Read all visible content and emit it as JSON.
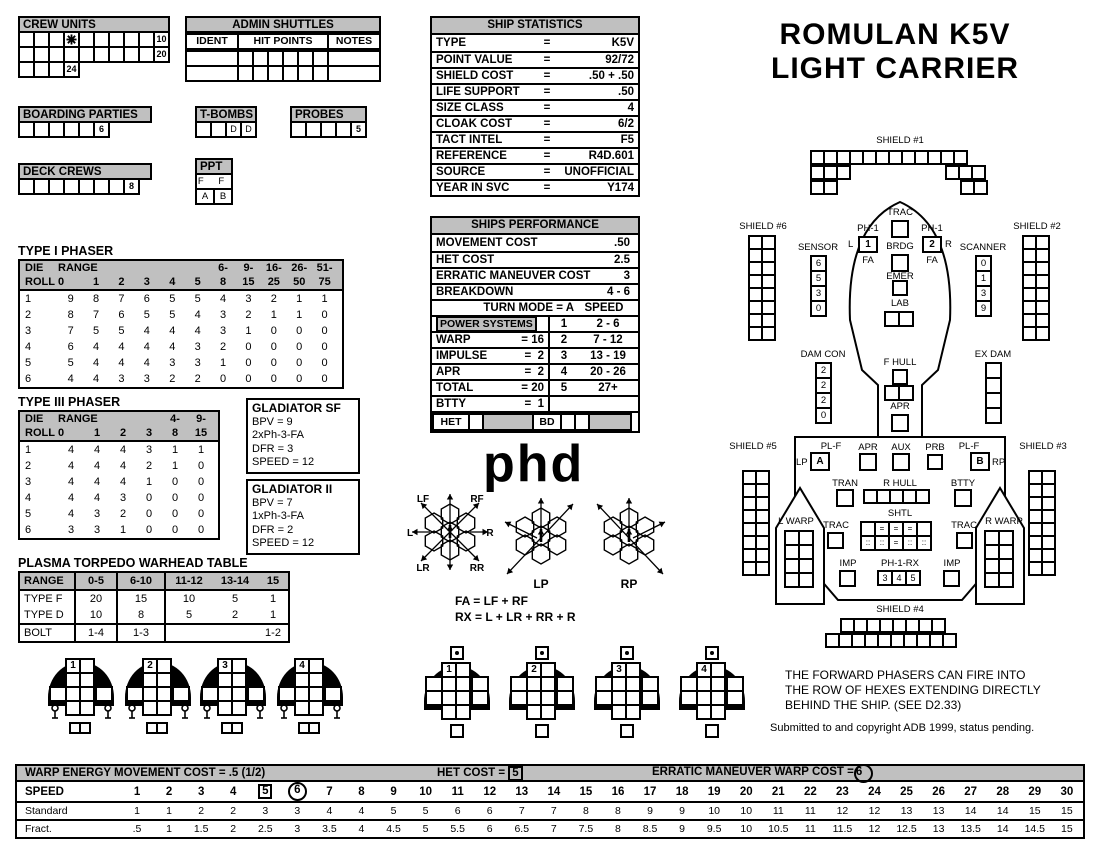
{
  "title": {
    "line1": "ROMULAN K5V",
    "line2": "LIGHT CARRIER"
  },
  "colors": {
    "header_gray": "#c0c0c0",
    "ink": "#000000"
  },
  "crew_units": {
    "title": "CREW UNITS",
    "rows": [
      {
        "cells": [
          "",
          "",
          "",
          "*",
          "",
          "",
          "",
          "",
          "",
          "10"
        ]
      },
      {
        "cells": [
          "",
          "",
          "",
          "",
          "",
          "",
          "",
          "",
          "",
          "20"
        ]
      },
      {
        "cells": [
          "",
          "",
          "",
          "24"
        ]
      }
    ]
  },
  "admin_shuttles": {
    "title": "ADMIN SHUTTLES",
    "columns": [
      "IDENT",
      "HIT POINTS",
      "NOTES"
    ],
    "hit_cells": 6,
    "rows": 2
  },
  "boarding_parties": {
    "title": "BOARDING PARTIES",
    "cells": [
      "",
      "",
      "",
      "",
      "",
      "6"
    ]
  },
  "t_bombs": {
    "title": "T-BOMBS",
    "cells": [
      "",
      "",
      "D",
      "D"
    ]
  },
  "probes": {
    "title": "PROBES",
    "cells": [
      "",
      "",
      "",
      "",
      "5"
    ]
  },
  "deck_crews": {
    "title": "DECK CREWS",
    "cells": [
      "",
      "",
      "",
      "",
      "",
      "",
      "",
      "8"
    ]
  },
  "ppt": {
    "title": "PPT",
    "row1": "F F",
    "row2": [
      "A",
      "B"
    ]
  },
  "ship_statistics": {
    "title": "SHIP STATISTICS",
    "rows": [
      {
        "label": "TYPE",
        "eq": "=",
        "value": "K5V"
      },
      {
        "label": "POINT VALUE",
        "eq": "=",
        "value": "92/72"
      },
      {
        "label": "SHIELD COST",
        "eq": "=",
        "value": ".50 + .50"
      },
      {
        "label": "LIFE SUPPORT",
        "eq": "=",
        "value": ".50"
      },
      {
        "label": "SIZE CLASS",
        "eq": "=",
        "value": "4"
      },
      {
        "label": "CLOAK COST",
        "eq": "=",
        "value": "6/2"
      },
      {
        "label": "TACT INTEL",
        "eq": "=",
        "value": "F5"
      },
      {
        "label": "REFERENCE",
        "eq": "=",
        "value": "R4D.601"
      },
      {
        "label": "SOURCE",
        "eq": "=",
        "value": "UNOFFICIAL"
      },
      {
        "label": "YEAR IN SVC",
        "eq": "=",
        "value": "Y174"
      }
    ]
  },
  "ships_performance": {
    "title": "SHIPS PERFORMANCE",
    "stat_rows": [
      {
        "label": "MOVEMENT COST",
        "value": ".50"
      },
      {
        "label": "HET COST",
        "value": "2.5"
      },
      {
        "label": "ERRATIC MANEUVER COST",
        "value": "3"
      },
      {
        "label": "BREAKDOWN",
        "value": "4 - 6"
      }
    ],
    "turn_mode": "TURN MODE = A",
    "speed_head": "SPEED",
    "power_label": "POWER SYSTEMS",
    "power_rows": [
      {
        "label": "WARP",
        "value": "= 16"
      },
      {
        "label": "IMPULSE",
        "value": "=  2"
      },
      {
        "label": "APR",
        "value": "=  2"
      },
      {
        "label": "TOTAL",
        "value": "= 20"
      },
      {
        "label": "BTTY",
        "value": "=  1"
      }
    ],
    "turn_rows": [
      [
        "1",
        "2 - 6"
      ],
      [
        "2",
        "7 - 12"
      ],
      [
        "3",
        "13 - 19"
      ],
      [
        "4",
        "20 - 26"
      ],
      [
        "5",
        "27+"
      ],
      [
        "",
        ""
      ]
    ],
    "het_label": "HET",
    "bd_label": "BD"
  },
  "type1_phaser": {
    "title": "TYPE I PHASER",
    "col_top": [
      "DIE",
      "RANGE",
      "",
      "",
      "",
      "",
      "",
      "6-",
      "9-",
      "16-",
      "26-",
      "51-"
    ],
    "col_bot": [
      "ROLL",
      "0",
      "1",
      "2",
      "3",
      "4",
      "5",
      "8",
      "15",
      "25",
      "50",
      "75"
    ],
    "rows": [
      {
        "die": "1",
        "vals": [
          "9",
          "8",
          "7",
          "6",
          "5",
          "5",
          "4",
          "3",
          "2",
          "1",
          "1"
        ]
      },
      {
        "die": "2",
        "vals": [
          "8",
          "7",
          "6",
          "5",
          "5",
          "4",
          "3",
          "2",
          "1",
          "1",
          "0"
        ]
      },
      {
        "die": "3",
        "vals": [
          "7",
          "5",
          "5",
          "4",
          "4",
          "4",
          "3",
          "1",
          "0",
          "0",
          "0"
        ]
      },
      {
        "die": "4",
        "vals": [
          "6",
          "4",
          "4",
          "4",
          "4",
          "3",
          "2",
          "0",
          "0",
          "0",
          "0"
        ]
      },
      {
        "die": "5",
        "vals": [
          "5",
          "4",
          "4",
          "4",
          "3",
          "3",
          "1",
          "0",
          "0",
          "0",
          "0"
        ]
      },
      {
        "die": "6",
        "vals": [
          "4",
          "4",
          "3",
          "3",
          "2",
          "2",
          "0",
          "0",
          "0",
          "0",
          "0"
        ]
      }
    ]
  },
  "type3_phaser": {
    "title": "TYPE III PHASER",
    "col_top": [
      "DIE",
      "RANGE",
      "",
      "",
      "",
      "4-",
      "9-"
    ],
    "col_bot": [
      "ROLL",
      "0",
      "1",
      "2",
      "3",
      "8",
      "15"
    ],
    "rows": [
      {
        "die": "1",
        "vals": [
          "4",
          "4",
          "4",
          "3",
          "1",
          "1"
        ]
      },
      {
        "die": "2",
        "vals": [
          "4",
          "4",
          "4",
          "2",
          "1",
          "0"
        ]
      },
      {
        "die": "3",
        "vals": [
          "4",
          "4",
          "4",
          "1",
          "0",
          "0"
        ]
      },
      {
        "die": "4",
        "vals": [
          "4",
          "4",
          "3",
          "0",
          "0",
          "0"
        ]
      },
      {
        "die": "5",
        "vals": [
          "4",
          "3",
          "2",
          "0",
          "0",
          "0"
        ]
      },
      {
        "die": "6",
        "vals": [
          "3",
          "3",
          "1",
          "0",
          "0",
          "0"
        ]
      }
    ]
  },
  "gladiator_sf": {
    "lines": [
      "GLADIATOR SF",
      "BPV = 9",
      "2xPh-3-FA",
      "DFR = 3",
      "SPEED = 12"
    ]
  },
  "gladiator_ii": {
    "lines": [
      "GLADIATOR II",
      "BPV = 7",
      "1xPh-3-FA",
      "DFR = 2",
      "SPEED = 12"
    ]
  },
  "plasma_table": {
    "title": "PLASMA TORPEDO WARHEAD TABLE",
    "header": [
      "RANGE",
      "0-5",
      "6-10",
      "11-12",
      "13-14",
      "15"
    ],
    "rows": [
      {
        "label": "TYPE F",
        "vals": [
          "20",
          "15",
          "10",
          "5",
          "1"
        ]
      },
      {
        "label": "TYPE D",
        "vals": [
          "10",
          "8",
          "5",
          "2",
          "1"
        ]
      },
      {
        "label": "BOLT",
        "vals": [
          "1-4",
          "1-3",
          "",
          "",
          "1-2"
        ]
      }
    ]
  },
  "phd": {
    "logo": "phd",
    "arc_labels": {
      "lf": "LF",
      "rf": "RF",
      "l": "L",
      "r": "R",
      "lr": "LR",
      "rr": "RR",
      "lp": "LP",
      "rp": "RP"
    },
    "formulas": [
      "FA = LF + RF",
      "RX = L + LR + RR + R"
    ]
  },
  "diagram": {
    "shield1": {
      "label": "SHIELD #1"
    },
    "shield2": {
      "label": "SHIELD #2"
    },
    "shield3": {
      "label": "SHIELD #3"
    },
    "shield4": {
      "label": "SHIELD #4"
    },
    "shield5": {
      "label": "SHIELD #5"
    },
    "shield6": {
      "label": "SHIELD #6"
    },
    "sensor": {
      "label": "SENSOR",
      "values": [
        "6",
        "5",
        "3",
        "0"
      ]
    },
    "scanner": {
      "label": "SCANNER",
      "values": [
        "0",
        "1",
        "3",
        "9"
      ]
    },
    "dam_con": {
      "label": "DAM CON",
      "values": [
        "2",
        "2",
        "2",
        "0"
      ]
    },
    "ex_dam": {
      "label": "EX DAM",
      "values": [
        "",
        "",
        "",
        ""
      ]
    },
    "trac": "TRAC",
    "brdg": "BRDG",
    "emer": "EMER",
    "lab": "LAB",
    "f_hull": "F HULL",
    "apr": "APR",
    "aux": "AUX",
    "prb": "PRB",
    "tran": "TRAN",
    "r_hull": "R HULL",
    "btty": "BTTY",
    "shtl": "SHTL",
    "imp": "IMP",
    "l_warp": "L WARP",
    "r_warp": "R WARP",
    "ph1_left": {
      "label": "PH-1",
      "side": "L",
      "num": "1",
      "arc": "FA"
    },
    "ph1_right": {
      "label": "PH-1",
      "side": "R",
      "num": "2",
      "arc": "FA"
    },
    "pl_f_left": {
      "label": "PL-F",
      "side": "LP",
      "letter": "A"
    },
    "pl_f_right": {
      "label": "PL-F",
      "side": "RP",
      "letter": "B"
    },
    "ph1_rx": {
      "label": "PH-1-RX",
      "cells": [
        "3",
        "4",
        "5"
      ]
    },
    "shtl_grid": [
      [
        "",
        "=",
        "=",
        "=",
        ""
      ],
      [
        "::",
        "::",
        "=",
        "::",
        "::"
      ]
    ],
    "notes": [
      "THE FORWARD PHASERS CAN FIRE INTO",
      "THE ROW OF HEXES EXTENDING DIRECTLY",
      "BEHIND THE SHIP. (SEE D2.33)"
    ],
    "copyright": "Submitted to and copyright ADB 1999, status pending."
  },
  "fighters": {
    "left_group": [
      {
        "num": "1"
      },
      {
        "num": "2"
      },
      {
        "num": "3"
      },
      {
        "num": "4"
      }
    ],
    "right_group": [
      {
        "num": "1"
      },
      {
        "num": "2"
      },
      {
        "num": "3"
      },
      {
        "num": "4"
      }
    ]
  },
  "bottom_table": {
    "header_left": "WARP ENERGY MOVEMENT COST = .5  (1/2)",
    "header_mid": "HET COST =",
    "het_value": "5",
    "header_right": "ERRATIC MANEUVER WARP COST =",
    "erratic_value": "6",
    "speed_label": "SPEED",
    "speeds": [
      "1",
      "2",
      "3",
      "4",
      "5",
      "6",
      "7",
      "8",
      "9",
      "10",
      "11",
      "12",
      "13",
      "14",
      "15",
      "16",
      "17",
      "18",
      "19",
      "20",
      "21",
      "22",
      "23",
      "24",
      "25",
      "26",
      "27",
      "28",
      "29",
      "30"
    ],
    "boxed_speed": "5",
    "circled_speed": "6",
    "standard_label": "Standard",
    "standard": [
      "1",
      "1",
      "2",
      "2",
      "3",
      "3",
      "4",
      "4",
      "5",
      "5",
      "6",
      "6",
      "7",
      "7",
      "8",
      "8",
      "9",
      "9",
      "10",
      "10",
      "11",
      "11",
      "12",
      "12",
      "13",
      "13",
      "14",
      "14",
      "15",
      "15"
    ],
    "fract_label": "Fract.",
    "fract": [
      ".5",
      "1",
      "1.5",
      "2",
      "2.5",
      "3",
      "3.5",
      "4",
      "4.5",
      "5",
      "5.5",
      "6",
      "6.5",
      "7",
      "7.5",
      "8",
      "8.5",
      "9",
      "9.5",
      "10",
      "10.5",
      "11",
      "11.5",
      "12",
      "12.5",
      "13",
      "13.5",
      "14",
      "14.5",
      "15"
    ]
  }
}
